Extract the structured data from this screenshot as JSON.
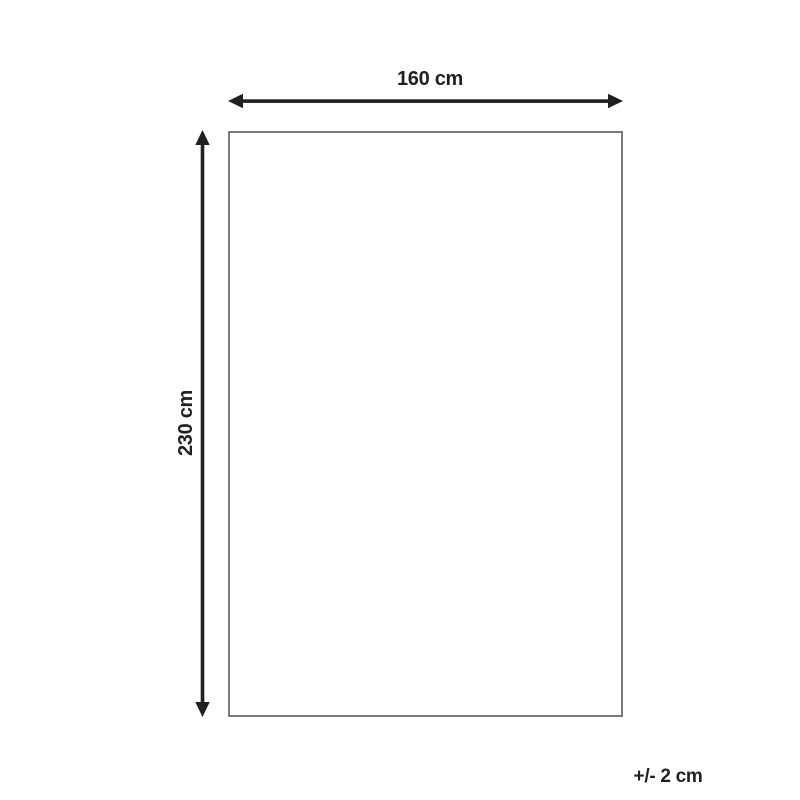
{
  "diagram": {
    "title": "product-dimension-diagram",
    "width_label": "160 cm",
    "height_label": "230 cm",
    "tolerance_label": "+/- 2 cm",
    "dimensions": {
      "width_cm": 160,
      "height_cm": 230,
      "tolerance_cm": 2
    },
    "colors": {
      "arrow": "#231f20",
      "outline": "#7b7b7b",
      "text": "#231f20",
      "background": "#ffffff"
    }
  }
}
